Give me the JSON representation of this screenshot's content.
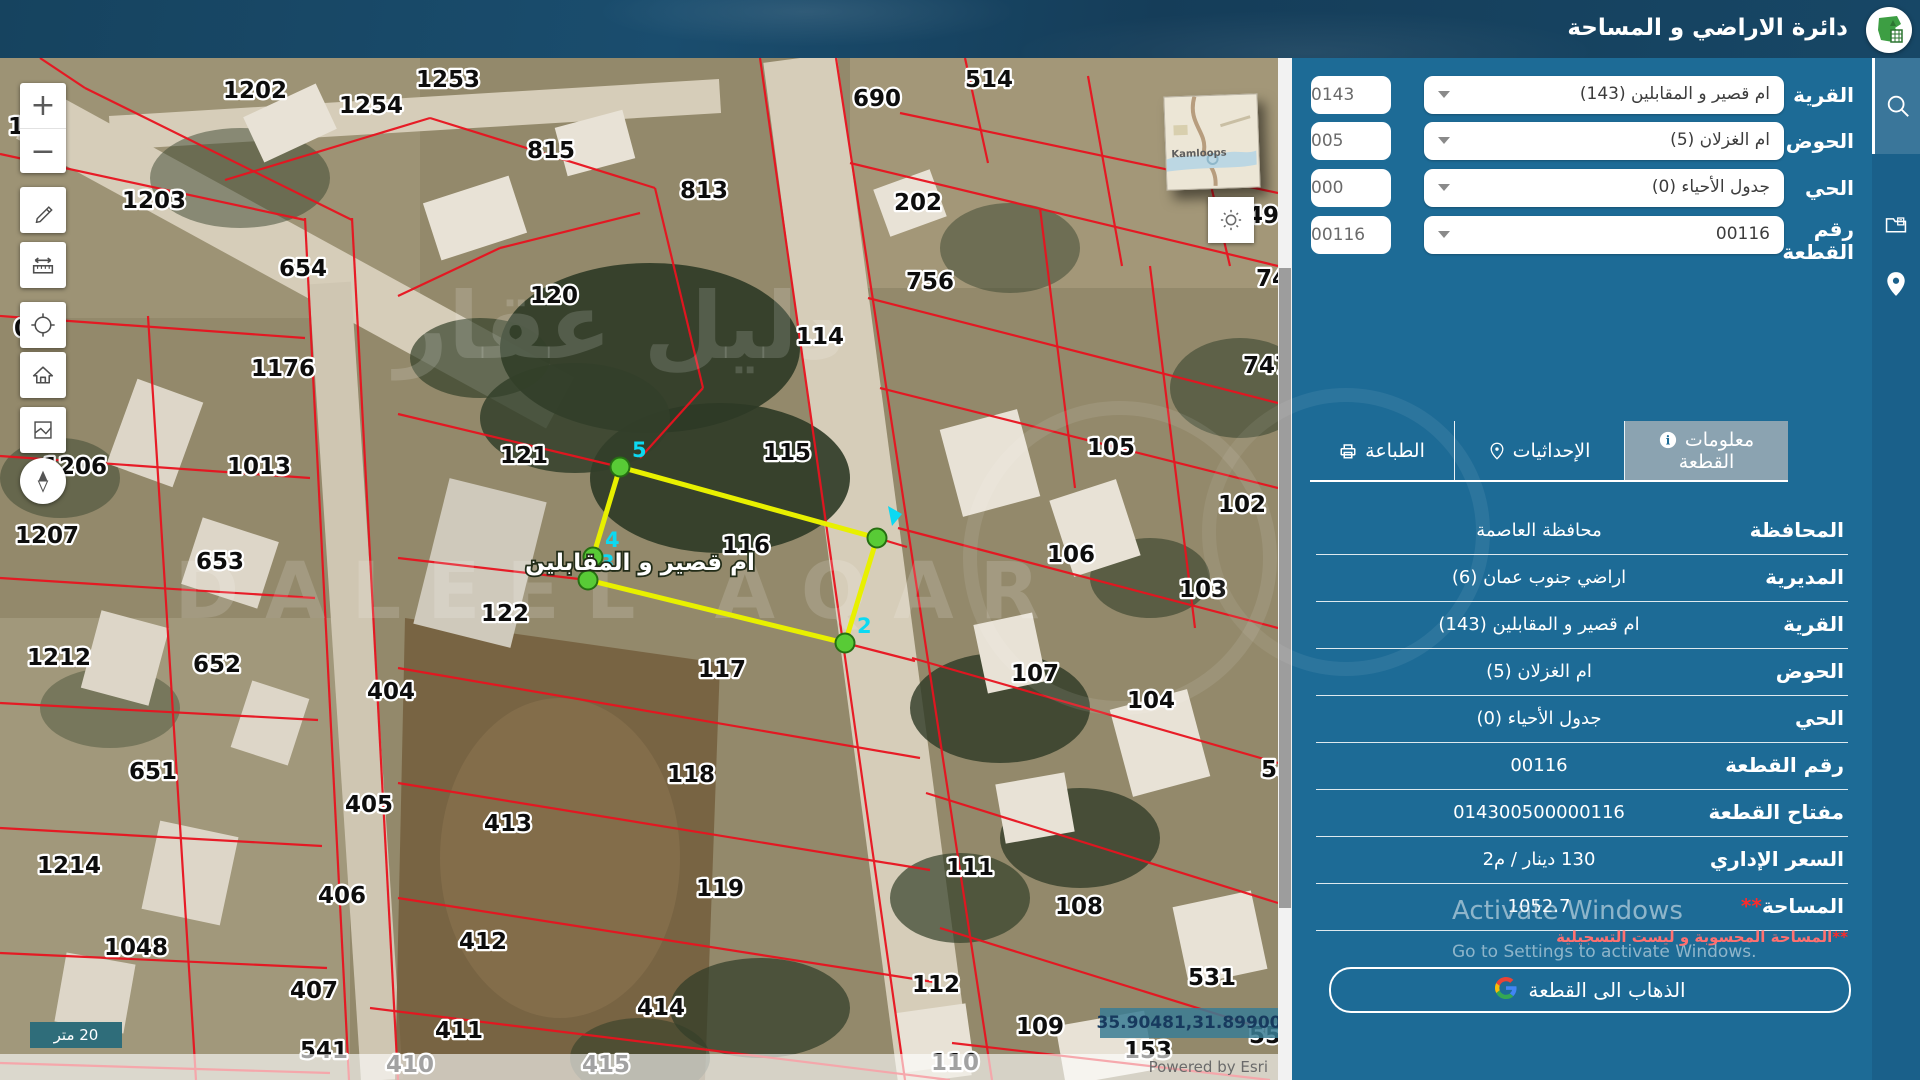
{
  "header": {
    "title": "دائرة الاراضي و المساحة"
  },
  "panel": {
    "form": {
      "rows": [
        {
          "label": "القرية",
          "value": "ام قصير و المقابلين (143)",
          "code": "0143"
        },
        {
          "label": "الحوض",
          "value": "ام الغزلان (5)",
          "code": "005"
        },
        {
          "label": "الحي",
          "value": "جدول الأحياء (0)",
          "code": "000"
        },
        {
          "label": "رقم القطعة",
          "value": "00116",
          "code": "00116"
        }
      ]
    },
    "tabs": [
      {
        "line1": "معلومات",
        "line2": "القطعة",
        "icon": "info"
      },
      {
        "line1": "الإحداثيات",
        "icon": "pin"
      },
      {
        "line1": "الطباعة",
        "icon": "printer"
      }
    ],
    "table": {
      "rows": [
        {
          "label": "المحافظة",
          "value": "محافظة العاصمة"
        },
        {
          "label": "المديرية",
          "value": "اراضي جنوب عمان (6)"
        },
        {
          "label": "القرية",
          "value": "ام قصير و المقابلين (143)"
        },
        {
          "label": "الحوض",
          "value": "ام الغزلان (5)"
        },
        {
          "label": "الحي",
          "value": "جدول الأحياء (0)"
        },
        {
          "label": "رقم القطعة",
          "value": "00116"
        },
        {
          "label": "مفتاح القطعة",
          "value": "014300500000116"
        },
        {
          "label": "السعر الإداري",
          "value": "130 دينار / م2"
        },
        {
          "label": "المساحة",
          "stars": "**",
          "value": "1052.7"
        }
      ]
    },
    "note_stars": "**",
    "note": "المساحة المحسوبة و ليست التسجيلية",
    "go_button": "الذهاب الى القطعة",
    "activate": {
      "line1": "Activate Windows",
      "line2": "Go to Settings to activate Windows."
    }
  },
  "map": {
    "scale_label": "20 متر",
    "coordinates": "35.90481,31.89900",
    "attribution": "Powered by Esri",
    "inset_label": "Kamloops",
    "watermark_ar": "دليل عقار",
    "watermark_en": "DALEEL AQAR",
    "selected_parcel": {
      "number": "116",
      "name": "ام قصير و المقابلين",
      "outline_color": "#e8f000",
      "vertex_color": "#58cb36",
      "points": [
        {
          "x": 620,
          "y": 409,
          "label": "5"
        },
        {
          "x": 877,
          "y": 480,
          "label": ""
        },
        {
          "x": 845,
          "y": 585,
          "label": "2"
        },
        {
          "x": 588,
          "y": 522,
          "label": "3"
        },
        {
          "x": 593,
          "y": 499,
          "label": "4"
        }
      ]
    },
    "parcels": [
      {
        "n": "1202",
        "x": 223,
        "y": 40
      },
      {
        "n": "1254",
        "x": 339,
        "y": 55
      },
      {
        "n": "1253",
        "x": 416,
        "y": 29
      },
      {
        "n": "690",
        "x": 853,
        "y": 48
      },
      {
        "n": "514",
        "x": 965,
        "y": 29
      },
      {
        "n": "815",
        "x": 527,
        "y": 100
      },
      {
        "n": "813",
        "x": 680,
        "y": 140
      },
      {
        "n": "202",
        "x": 894,
        "y": 152
      },
      {
        "n": "1203",
        "x": 122,
        "y": 150
      },
      {
        "n": "654",
        "x": 279,
        "y": 218
      },
      {
        "n": "120",
        "x": 530,
        "y": 245
      },
      {
        "n": "114",
        "x": 796,
        "y": 286
      },
      {
        "n": "756",
        "x": 906,
        "y": 231
      },
      {
        "n": "748",
        "x": 1256,
        "y": 228
      },
      {
        "n": "49",
        "x": 1247,
        "y": 165
      },
      {
        "n": "747",
        "x": 1243,
        "y": 315
      },
      {
        "n": "04",
        "x": 14,
        "y": 278
      },
      {
        "n": "10",
        "x": 8,
        "y": 76
      },
      {
        "n": "1176",
        "x": 251,
        "y": 318
      },
      {
        "n": "1013",
        "x": 227,
        "y": 416
      },
      {
        "n": "121",
        "x": 500,
        "y": 405
      },
      {
        "n": "115",
        "x": 763,
        "y": 402
      },
      {
        "n": "105",
        "x": 1087,
        "y": 397
      },
      {
        "n": "102",
        "x": 1218,
        "y": 454
      },
      {
        "n": "1206",
        "x": 43,
        "y": 416
      },
      {
        "n": "653",
        "x": 196,
        "y": 511
      },
      {
        "n": "122",
        "x": 481,
        "y": 563
      },
      {
        "n": "116",
        "x": 722,
        "y": 495
      },
      {
        "n": "106",
        "x": 1047,
        "y": 504
      },
      {
        "n": "103",
        "x": 1179,
        "y": 539
      },
      {
        "n": "1207",
        "x": 15,
        "y": 485
      },
      {
        "n": "652",
        "x": 193,
        "y": 614
      },
      {
        "n": "404",
        "x": 367,
        "y": 641
      },
      {
        "n": "117",
        "x": 698,
        "y": 619
      },
      {
        "n": "107",
        "x": 1011,
        "y": 623
      },
      {
        "n": "104",
        "x": 1127,
        "y": 650
      },
      {
        "n": "1212",
        "x": 27,
        "y": 607
      },
      {
        "n": "651",
        "x": 129,
        "y": 721
      },
      {
        "n": "405",
        "x": 345,
        "y": 754
      },
      {
        "n": "413",
        "x": 484,
        "y": 773
      },
      {
        "n": "118",
        "x": 667,
        "y": 724
      },
      {
        "n": "542",
        "x": 1261,
        "y": 719
      },
      {
        "n": "1214",
        "x": 37,
        "y": 815
      },
      {
        "n": "406",
        "x": 318,
        "y": 845
      },
      {
        "n": "412",
        "x": 459,
        "y": 891
      },
      {
        "n": "119",
        "x": 696,
        "y": 838
      },
      {
        "n": "111",
        "x": 946,
        "y": 817
      },
      {
        "n": "108",
        "x": 1055,
        "y": 856
      },
      {
        "n": "1048",
        "x": 104,
        "y": 897
      },
      {
        "n": "407",
        "x": 290,
        "y": 940
      },
      {
        "n": "411",
        "x": 435,
        "y": 980
      },
      {
        "n": "414",
        "x": 637,
        "y": 957
      },
      {
        "n": "112",
        "x": 912,
        "y": 934
      },
      {
        "n": "531",
        "x": 1188,
        "y": 927
      },
      {
        "n": "109",
        "x": 1016,
        "y": 976
      },
      {
        "n": "541",
        "x": 300,
        "y": 1000
      },
      {
        "n": "410",
        "x": 386,
        "y": 1014
      },
      {
        "n": "415",
        "x": 582,
        "y": 1014
      },
      {
        "n": "153",
        "x": 1124,
        "y": 1000
      },
      {
        "n": "552",
        "x": 1249,
        "y": 985
      },
      {
        "n": "110",
        "x": 931,
        "y": 1012
      }
    ]
  }
}
